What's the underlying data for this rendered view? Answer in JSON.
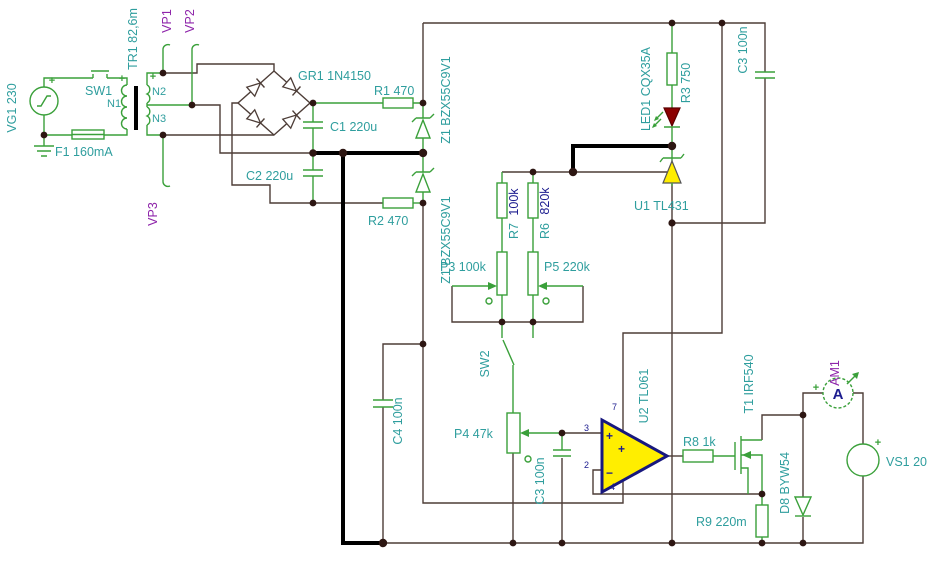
{
  "title": "Power supply schematic",
  "labels": {
    "vg1": "VG1 230",
    "sw1": "SW1",
    "f1": "F1 160mA",
    "tr1": "TR1 82,6m",
    "n1": "N1",
    "n2": "N2",
    "n3": "N3",
    "vp1": "VP1",
    "vp2": "VP2",
    "vp3": "VP3",
    "gr1": "GR1 1N4150",
    "c1": "C1 220u",
    "c2": "C2 220u",
    "r1": "R1 470",
    "r2": "R2 470",
    "z1a": "Z1 BZX55C9V1",
    "z1b": "Z1 BZX55C9V1",
    "r7_ref": "R7",
    "r7_value": "100k",
    "r6_ref": "R6",
    "r6_value": "820k",
    "p3": "P3 100k",
    "p5": "P5 220k",
    "sw2": "SW2",
    "p4": "P4 47k",
    "c4": "C4 100n",
    "c3_top": "C3 100n",
    "c3_bottom": "C3 100n",
    "r3": "R3 750",
    "led1": "LED1 CQX35A",
    "u1": "U1 TL431",
    "u2": "U2 TL061",
    "r8": "R8 1k",
    "t1": "T1 IRF540",
    "r9": "R9 220m",
    "d8": "D8 BYW54",
    "am1": "AM1",
    "vs1": "VS1 20"
  },
  "symbols": {
    "plus": "+",
    "minus": "−",
    "ammeter_letter": "A",
    "pin2": "2",
    "pin3": "3",
    "pin4": "4",
    "pin7": "7"
  },
  "colors": {
    "teal": "#2f9e9e",
    "purple": "#8e24aa",
    "navy": "#1c1c8f",
    "green": "#3aa03a",
    "wire": "#4d3d37",
    "black": "#000000",
    "led_fill": "#8b0000",
    "ic_fill": "#ffee00"
  }
}
